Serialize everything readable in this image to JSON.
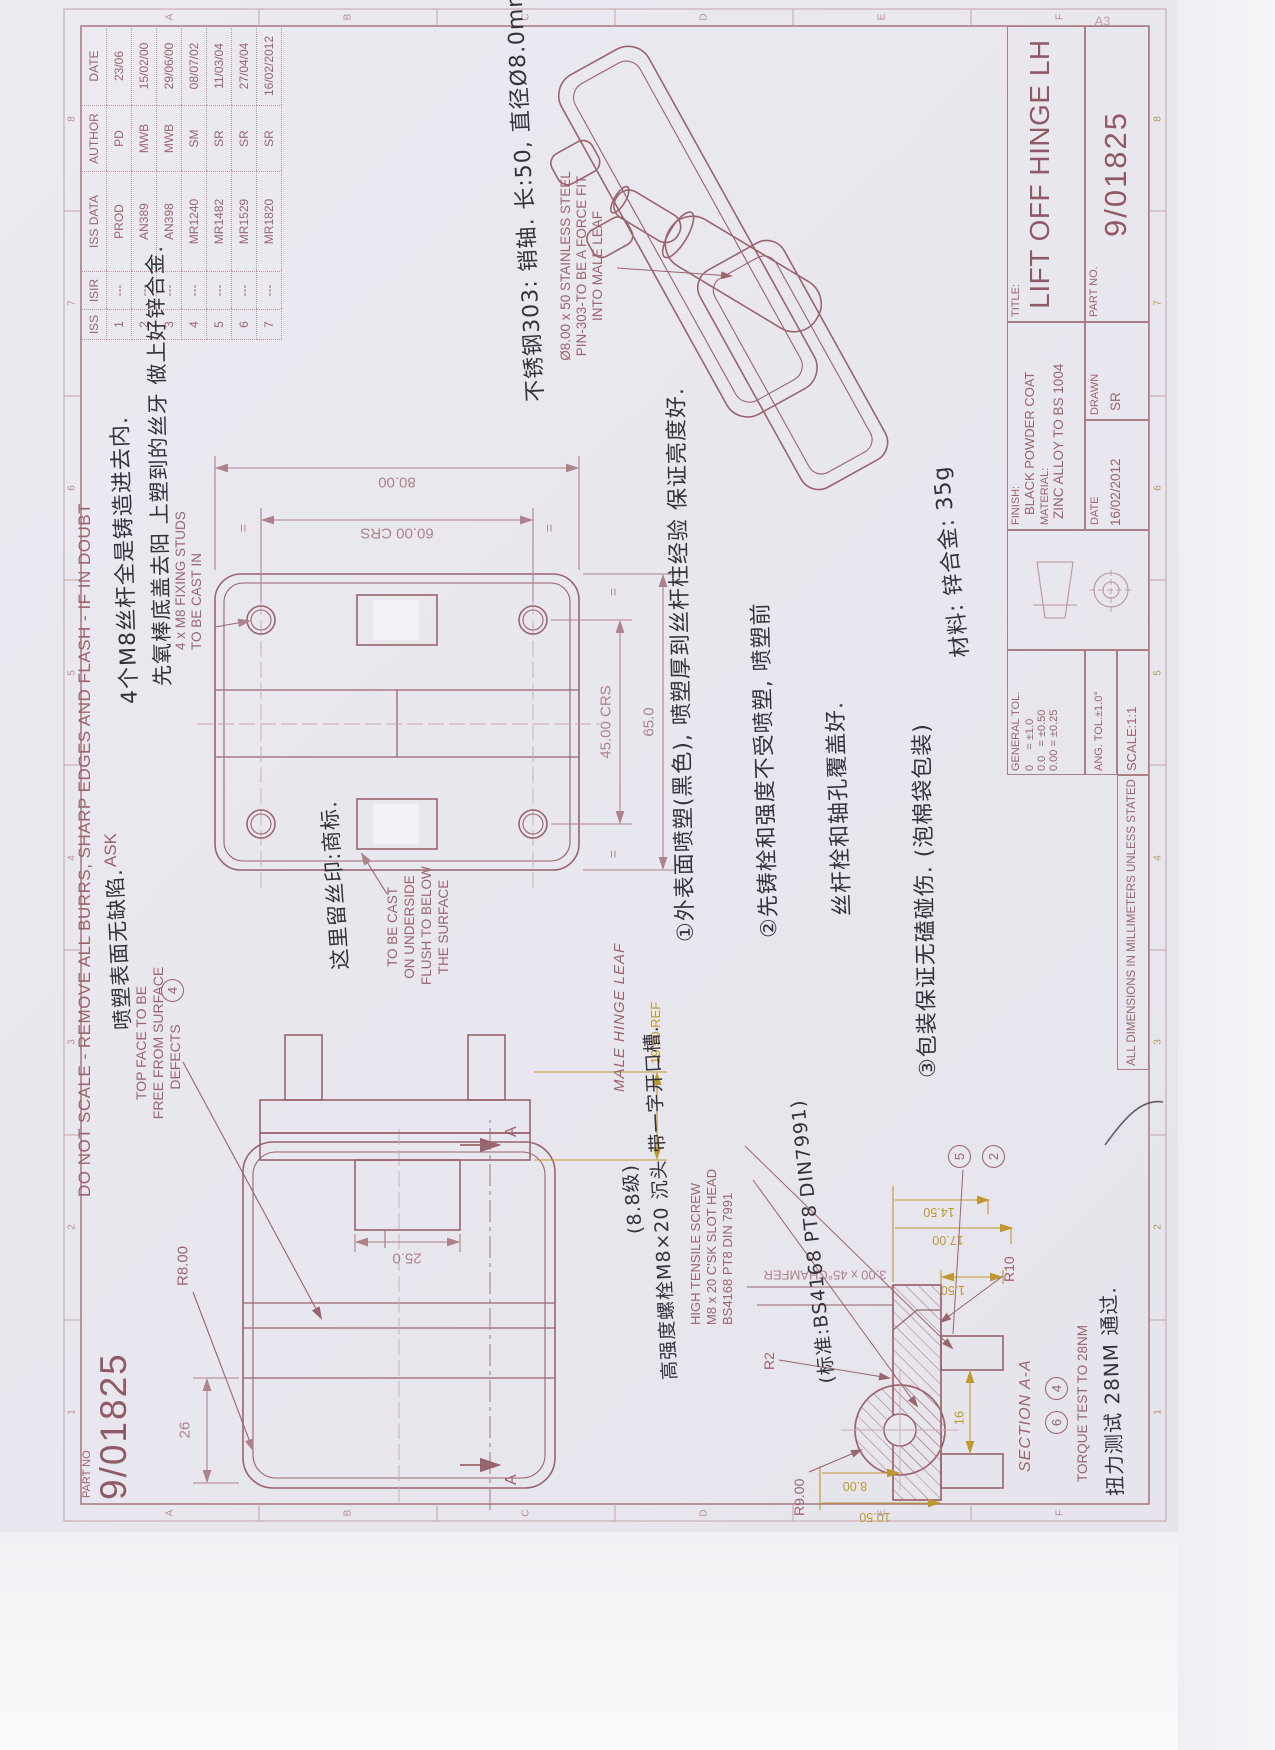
{
  "sheet": {
    "size": "A3",
    "corner_part_no_label": "PART NO",
    "corner_part_no": "9/01825"
  },
  "edge_note": {
    "line1": "DO NOT SCALE - REMOVE ALL BURRS, SHARP EDGES AND FLASH - IF IN DOUBT",
    "line2": "ASK"
  },
  "zones": {
    "numbers": [
      "1",
      "2",
      "3",
      "4",
      "5",
      "6",
      "7",
      "8"
    ],
    "letters": [
      "A",
      "B",
      "C",
      "D",
      "E",
      "F"
    ]
  },
  "revisions": {
    "headers": [
      "ISS",
      "ISIR",
      "ISS DATA",
      "AUTHOR",
      "DATE"
    ],
    "rows": [
      [
        "1",
        "---",
        "PROD",
        "PD",
        "23/06"
      ],
      [
        "2",
        "---",
        "AN389",
        "MWB",
        "15/02/00"
      ],
      [
        "3",
        "---",
        "AN398",
        "MWB",
        "29/06/00"
      ],
      [
        "4",
        "---",
        "MR1240",
        "SM",
        "08/07/02"
      ],
      [
        "5",
        "---",
        "MR1482",
        "SR",
        "11/03/04"
      ],
      [
        "6",
        "---",
        "MR1529",
        "SR",
        "27/04/04"
      ],
      [
        "7",
        "---",
        "MR1820",
        "SR",
        "16/02/2012"
      ]
    ]
  },
  "title_block": {
    "title_label": "TITLE:",
    "title": "LIFT OFF HINGE LH",
    "part_no_label": "PART NO.",
    "part_no": "9/01825",
    "finish_label": "FINISH:",
    "finish": "BLACK POWDER COAT",
    "material_label": "MATERIAL:",
    "material": "ZINC ALLOY TO BS 1004",
    "general_tol_label": "GENERAL TOL.",
    "tol_lines": [
      "0     = ±1.0",
      "0.0   = ±0.50",
      "0.00 = ±0.25"
    ],
    "ang_tol": "ANG. TOL.±1.0°",
    "scale": "SCALE:1:1",
    "date_label": "DATE",
    "date": "16/02/2012",
    "drawn_label": "DRAWN",
    "drawn": "SR",
    "all_dims": "ALL DIMENSIONS IN MILLIMETERS UNLESS STATED"
  },
  "plan_view": {
    "stud_note_l1": "4 x M8 FIXING STUDS",
    "stud_note_l2": "TO BE CAST IN",
    "cast_note": [
      "TO BE CAST",
      "ON UNDERSIDE",
      "FLUSH TO BELOW",
      "THE SURFACE"
    ],
    "dims": {
      "height": "80.00",
      "crs_v": "60.00 CRS",
      "crs_h": "45.00 CRS",
      "width": "65.0",
      "eq": "="
    }
  },
  "front_view": {
    "top_face_note": [
      "TOP FACE TO BE",
      "FREE FROM SURFACE",
      "DEFECTS"
    ],
    "top_face_balloon": "4",
    "r8": "R8.00",
    "d26": "26",
    "a_label": "A"
  },
  "male_view": {
    "label": "MALE HINGE LEAF",
    "d25": "25.0",
    "ref": "19.50 REF"
  },
  "section": {
    "label": "SECTION A-A",
    "torque": "TORQUE TEST TO 28NM",
    "chamfer": "3.00 x 45°CHAMFER",
    "screw_note": [
      "HIGH TENSILE SCREW",
      "M8 x 20 C'SK SLOT HEAD",
      "BS4168 PT8 DIN 7991"
    ],
    "dims": {
      "d150": "1.50",
      "d17": "17.00",
      "d145": "14.50",
      "d16": "16",
      "d8": "8.00",
      "d105": "10.50",
      "r10": "R10",
      "r9": "R9.00",
      "r2": "R2"
    },
    "balloons": [
      "5",
      "2",
      "6",
      "4"
    ]
  },
  "iso_view": {
    "pin_note": [
      "Ø8.00 x 50 STAINLESS STEEL",
      "PIN-303-TO BE A FORCE FIT",
      "INTO MALE LEAF"
    ]
  },
  "handwritten": {
    "pin": "不锈钢303: 销轴. 长:50, 直径Ø8.0mm",
    "m8_1": "4个M8丝杆全是铸造进去内.",
    "m8_2": "先氧棒底盖去阳 上塑到的丝牙 做上好锌合金.",
    "slot": "这里留丝印:商标.",
    "top_face": "喷塑表面无缺陷.",
    "note1": "①外表面喷塑(黑色), 喷塑厚到丝杆柱经验 保证亮度好.",
    "note2": "②先铸栓和强度不受喷塑, 喷塑前",
    "note2b": "丝杆栓和轴孔覆盖好.",
    "note3": "③包装保证无磕碰伤. (泡棉袋包装)",
    "material": "材料: 锌合金: 35g",
    "screw1": "(8.8级)",
    "screw2": "高强度螺栓M8×20 沉头 带一字开口槽.",
    "screw3": "(标准:BS4168 PT8 DIN7991)",
    "torque": "扭力测试 28NM 通过."
  },
  "colors": {
    "print_ink": "#9a646c",
    "inspection_yellow": "#bd982f",
    "handwriting": "#26262e",
    "paper": "#e9e7ee"
  }
}
